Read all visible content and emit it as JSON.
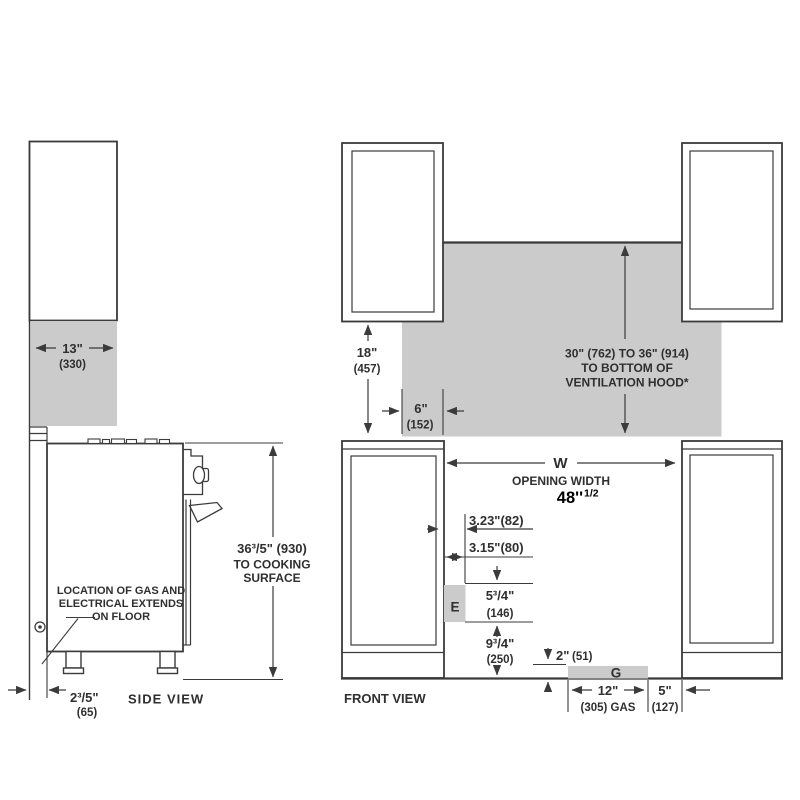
{
  "colors": {
    "line": "#3b3b3b",
    "gray_fill": "#cbcbcb",
    "text": "#2f2f2f",
    "highlight_text": "#000000"
  },
  "side_view": {
    "label": "SIDE VIEW",
    "cabinet_depth": {
      "inches": "13\"",
      "mm": "(330)"
    },
    "height_dim": {
      "line1": "36³/5\" (930)",
      "line2": "TO COOKING",
      "line3": "SURFACE"
    },
    "gas_note": {
      "line1": "LOCATION OF GAS AND",
      "line2": "ELECTRICAL EXTENDS",
      "line3": "ON FLOOR"
    },
    "wall_gap": {
      "inches": "2³/5\"",
      "mm": "(65)"
    }
  },
  "front_view": {
    "label": "FRONT VIEW",
    "cabinet_to_counter": {
      "inches": "18\"",
      "mm": "(457)"
    },
    "hood_overhang": {
      "inches": "6\"",
      "mm": "(152)"
    },
    "hood_clearance": {
      "line1": "30\" (762) TO 36\" (914)",
      "line2": "TO BOTTOM OF",
      "line3": "VENTILATION HOOD*"
    },
    "opening": {
      "letter": "W",
      "label": "OPENING WIDTH",
      "value_main": "48''",
      "value_frac": "1/2"
    },
    "electrical_offset_1": "3.23\"(82)",
    "electrical_offset_2": "3.15\"(80)",
    "electrical_label": "E",
    "electrical_height": {
      "inches": "5³/4\"",
      "mm": "(146)"
    },
    "electrical_floor": {
      "inches": "9³/4\"",
      "mm": "(250)"
    },
    "gas_height": {
      "inches": "2\"",
      "mm": "(51)"
    },
    "gas_label": "G",
    "gas_width": {
      "inches": "12\"",
      "mm": "(305) GAS"
    },
    "gas_offset": {
      "inches": "5\"",
      "mm": "(127)"
    }
  }
}
